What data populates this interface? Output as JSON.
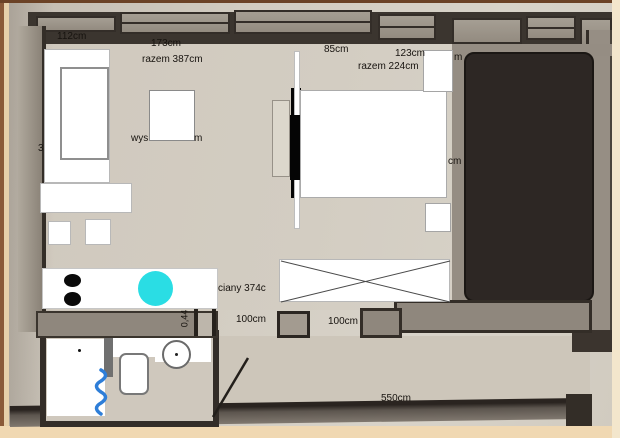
{
  "plan": {
    "measurements": {
      "sofa_width": "112cm",
      "top_left_wall": "173cm",
      "top_left_total": "razem 387cm",
      "bed_side_wall": "85cm",
      "bed_width": "123cm",
      "bed_width_partial": "m",
      "top_right_total": "razem 224cm",
      "height_label_prefix": "wys",
      "height_label_suffix": "m",
      "left_wall_partial": "3",
      "right_wall_partial": "cm",
      "mid_wall": "ciany 374c",
      "door_width": "0,44",
      "gap_left": "100cm",
      "gap_right": "100cm",
      "bottom_wall": "550cm"
    },
    "colors": {
      "sink": "#2adde4",
      "squiggle": "#2e7ed8",
      "dark_room": "#2d2724",
      "wall_gray": "#958d83",
      "wall_dark": "#38322c",
      "paper": "#d4cec3",
      "photo_edge": "#e9d3ac"
    }
  }
}
